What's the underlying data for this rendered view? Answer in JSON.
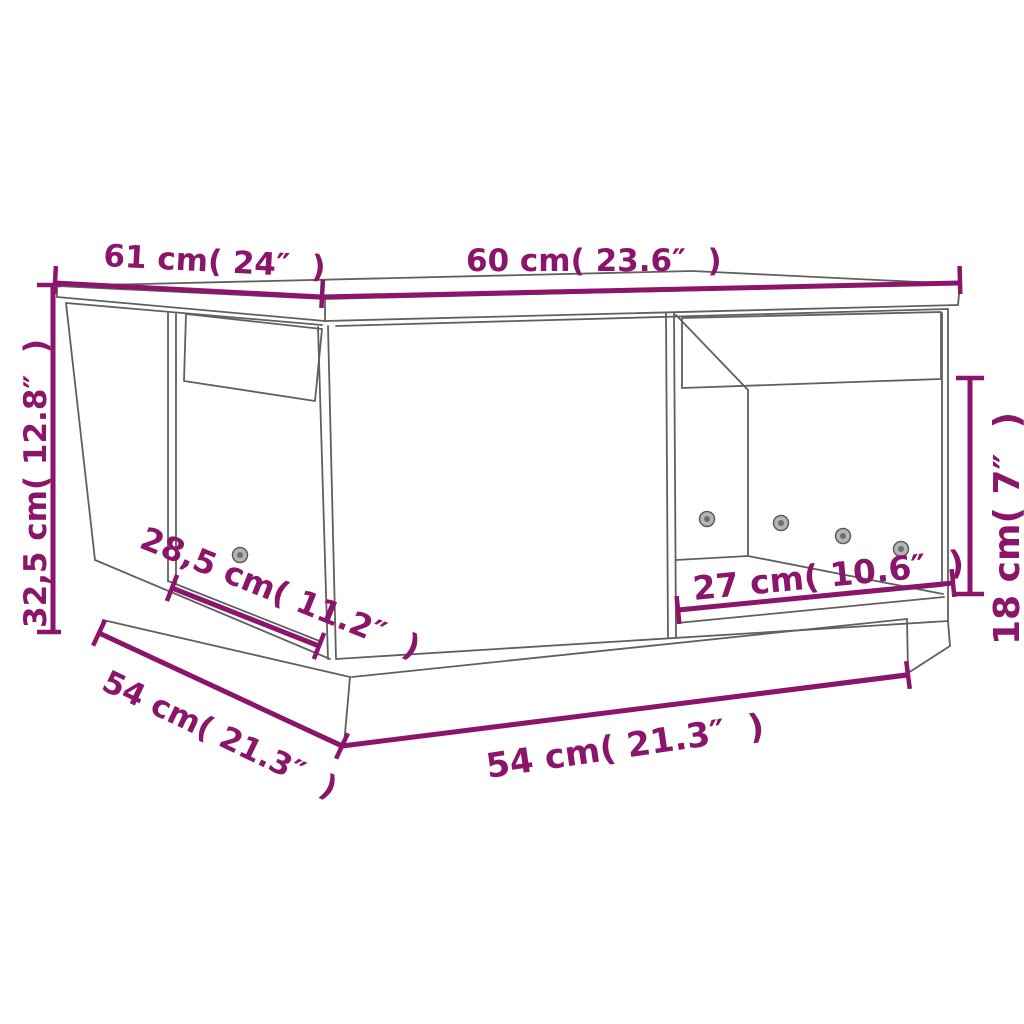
{
  "image": {
    "kind": "product-dimension-diagram",
    "subject": "coffee table with two open compartments, line drawing",
    "style": {
      "accent_color": "#8A156A",
      "line_color": "#606060",
      "background_color": "#ffffff"
    }
  },
  "dimensions": {
    "top_depth": {
      "label": "61 cm( 24″  )"
    },
    "top_width": {
      "label": "60 cm( 23.6″  )"
    },
    "height": {
      "label": "32,5 cm( 12.8″  )"
    },
    "left_opening_width": {
      "label": "28,5 cm( 11.2″  )"
    },
    "base_depth": {
      "label": "54 cm( 21.3″  )"
    },
    "base_width": {
      "label": "54 cm( 21.3″  )"
    },
    "right_opening_width": {
      "label": "27 cm( 10.6″  )"
    },
    "right_opening_height": {
      "label": "18 cm( 7″  )"
    }
  }
}
